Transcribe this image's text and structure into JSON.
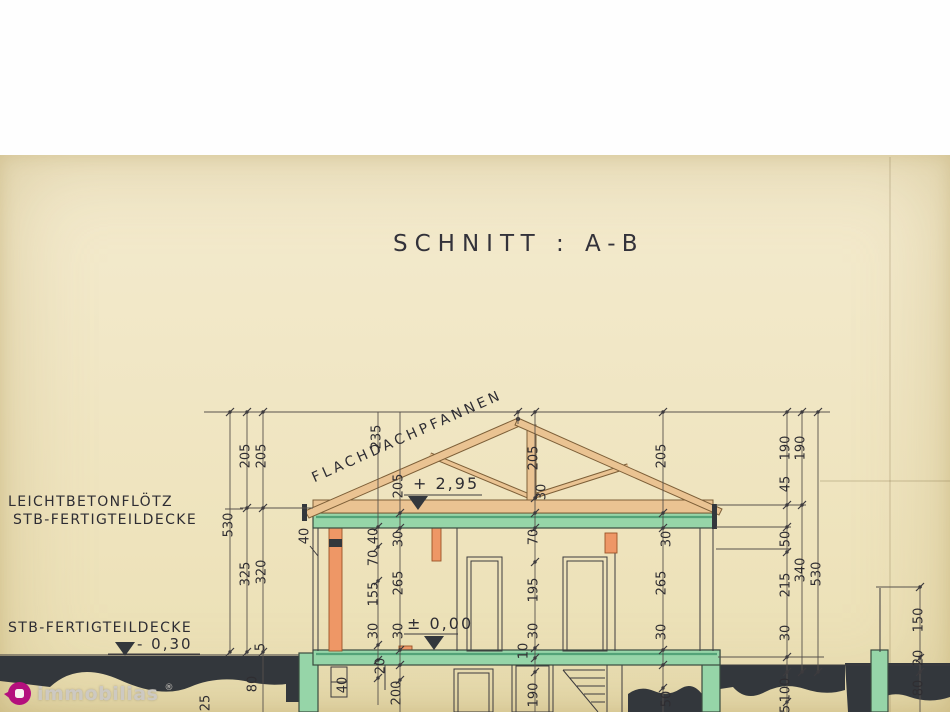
{
  "page": {
    "title": "SCHNITT : A-B"
  },
  "annotations": {
    "roof_covering": "FLACHDACHPFANNEN",
    "ceiling_note_line1": "LEICHTBETONFLÖTZ",
    "ceiling_note_line2": "STB-FERTIGTEILDECKE",
    "basement_ceiling_note": "STB-FERTIGTEILDECKE"
  },
  "levels": {
    "ridge": "+ 2,95",
    "ground_floor": "± 0,00",
    "basement": "- 0,30"
  },
  "watermark": {
    "text": "immobilias",
    "registered": "®"
  },
  "colors": {
    "paper": "#efe5c2",
    "slab_green": "#96d5a8",
    "timber": "#eac392",
    "column_orange": "#ee9766",
    "ground_dark": "#33373c",
    "line": "#3d3b3e",
    "logo_magenta": "#b4107d"
  },
  "dimensions": [
    {
      "v": "530",
      "x": 229,
      "y": 525
    },
    {
      "v": "205",
      "x": 246,
      "y": 456
    },
    {
      "v": "325",
      "x": 246,
      "y": 574
    },
    {
      "v": "205",
      "x": 262,
      "y": 456
    },
    {
      "v": "320",
      "x": 262,
      "y": 572
    },
    {
      "v": "5",
      "x": 261,
      "y": 647
    },
    {
      "v": "80",
      "x": 253,
      "y": 684
    },
    {
      "v": "25",
      "x": 206,
      "y": 703
    },
    {
      "v": "235",
      "x": 377,
      "y": 437
    },
    {
      "v": "40",
      "x": 305,
      "y": 536
    },
    {
      "v": "40",
      "x": 374,
      "y": 536
    },
    {
      "v": "70",
      "x": 374,
      "y": 558
    },
    {
      "v": "155",
      "x": 374,
      "y": 594
    },
    {
      "v": "30",
      "x": 374,
      "y": 631
    },
    {
      "v": "20",
      "x": 381,
      "y": 666
    },
    {
      "v": "40",
      "x": 343,
      "y": 685
    },
    {
      "v": "200",
      "x": 397,
      "y": 693
    },
    {
      "v": "205",
      "x": 399,
      "y": 486
    },
    {
      "v": "30",
      "x": 399,
      "y": 539
    },
    {
      "v": "265",
      "x": 399,
      "y": 583
    },
    {
      "v": "30",
      "x": 399,
      "y": 631
    },
    {
      "v": "205",
      "x": 534,
      "y": 458
    },
    {
      "v": "30",
      "x": 542,
      "y": 492
    },
    {
      "v": "70",
      "x": 534,
      "y": 537
    },
    {
      "v": "195",
      "x": 534,
      "y": 590
    },
    {
      "v": "30",
      "x": 534,
      "y": 631
    },
    {
      "v": "10",
      "x": 524,
      "y": 651
    },
    {
      "v": "190",
      "x": 534,
      "y": 695
    },
    {
      "v": "205",
      "x": 662,
      "y": 456
    },
    {
      "v": "30",
      "x": 667,
      "y": 539
    },
    {
      "v": "265",
      "x": 662,
      "y": 583
    },
    {
      "v": "30",
      "x": 662,
      "y": 632
    },
    {
      "v": "50",
      "x": 667,
      "y": 699
    },
    {
      "v": "190",
      "x": 786,
      "y": 448
    },
    {
      "v": "45",
      "x": 786,
      "y": 484
    },
    {
      "v": "50",
      "x": 786,
      "y": 539
    },
    {
      "v": "215",
      "x": 786,
      "y": 585
    },
    {
      "v": "30",
      "x": 786,
      "y": 633
    },
    {
      "v": "100",
      "x": 786,
      "y": 690
    },
    {
      "v": "5",
      "x": 786,
      "y": 709
    },
    {
      "v": "190",
      "x": 801,
      "y": 448
    },
    {
      "v": "340",
      "x": 801,
      "y": 570
    },
    {
      "v": "530",
      "x": 817,
      "y": 574
    },
    {
      "v": "150",
      "x": 919,
      "y": 620
    },
    {
      "v": "20",
      "x": 919,
      "y": 658
    },
    {
      "v": "80",
      "x": 919,
      "y": 688
    }
  ]
}
